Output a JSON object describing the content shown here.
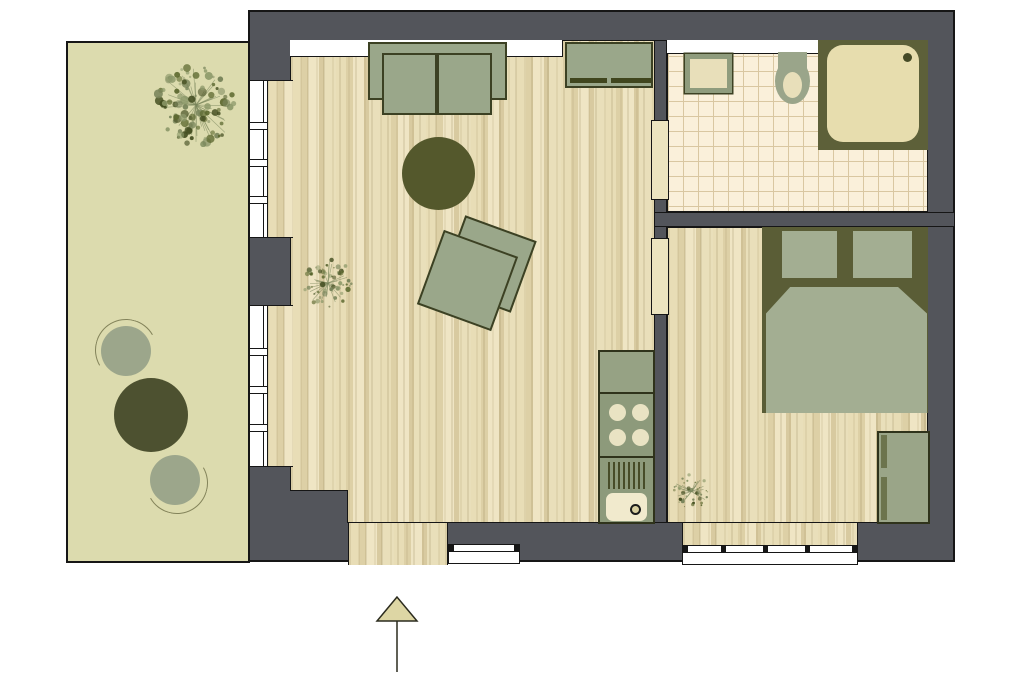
{
  "plan": {
    "title": "apartment-floor-plan",
    "rooms": [
      {
        "id": "balcony"
      },
      {
        "id": "living-room-with-kitchenette"
      },
      {
        "id": "bathroom"
      },
      {
        "id": "bedroom"
      }
    ],
    "entrance_marker": "entrance-arrow"
  },
  "palette": {
    "wall": "#53555b",
    "outline": "#161616",
    "balcony_floor": "#dcdbae",
    "wood_floor": "#e9dfba",
    "tile_floor": "#faf0da",
    "tile_grid": "#d9c7a1",
    "furniture_green": "#9aa78a",
    "furniture_dark_olive": "#54582c",
    "fixture_beige": "#e7ddae",
    "window_white": "#ffffff"
  },
  "furniture": {
    "balcony": {
      "tree": "tree",
      "chair_top": "round-chair",
      "table": "round-table",
      "chair_bottom": "round-chair"
    },
    "living_room": {
      "sofa": "two-seat-sofa",
      "rug": "round-rug",
      "armchair": "armchair",
      "sideboard": "sideboard",
      "plant": "potted-plant",
      "kitchenette_counter": "counter",
      "kitchenette_stove": "stove-four-burners",
      "kitchenette_sink": "sink-unit",
      "entrance": "entrance-opening",
      "window_top": "window",
      "window_bottom": "window",
      "balcony_door_upper": "balcony-window",
      "balcony_door_lower": "balcony-window"
    },
    "bathroom": {
      "washbasin": "washbasin",
      "toilet": "toilet",
      "shower": "shower",
      "window": "window",
      "door": "door"
    },
    "bedroom": {
      "bed": "double-bed-two-pillows",
      "wardrobe": "wardrobe",
      "plant": "potted-plant",
      "window": "window",
      "door": "door"
    }
  }
}
